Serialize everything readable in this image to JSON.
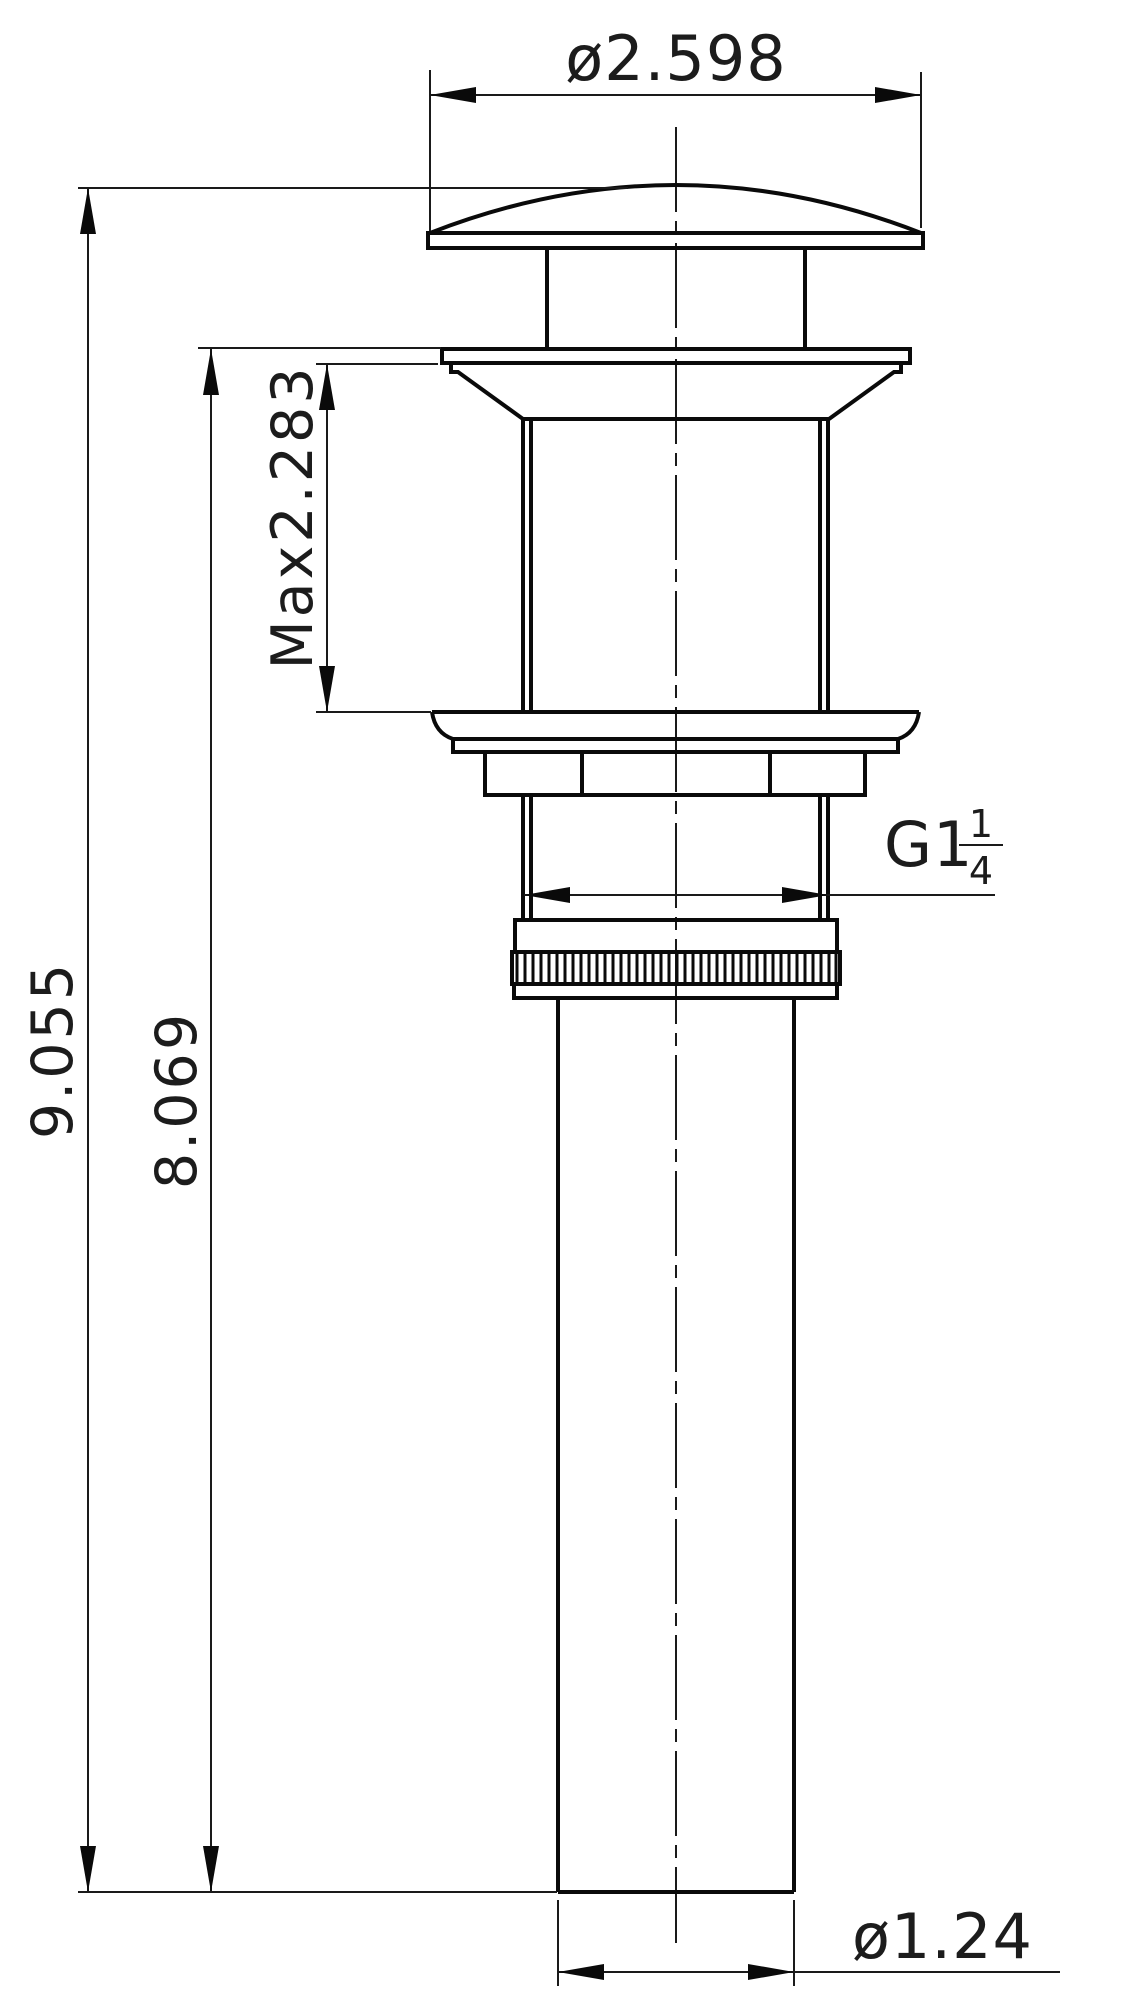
{
  "drawing": {
    "title": "pop-up drain stopper technical drawing",
    "background_color": "#ffffff",
    "line_color": "#0a0a0a",
    "dimensions": {
      "top_diameter": "ø2.598",
      "overall_height": "9.055",
      "install_height": "8.069",
      "max_deck_thickness": "Max2.283",
      "thread_size": "G1",
      "thread_fraction_numerator": "1",
      "thread_fraction_denominator": "4",
      "outlet_diameter": "ø1.24"
    }
  }
}
